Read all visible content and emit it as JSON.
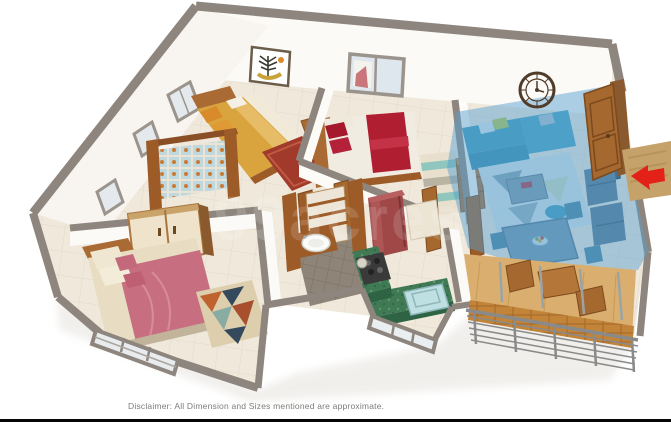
{
  "page": {
    "background_color": "#ffffff",
    "bottom_bar_color": "#050505"
  },
  "watermark": {
    "text": "99acres",
    "color": "#ffffff",
    "opacity": "0.14"
  },
  "disclaimer": {
    "text": "Disclaimer: All Dimension and Sizes mentioned are approximate."
  },
  "floorplan": {
    "type": "3d-isometric-apartment-floorplan",
    "highlight_color": "#569FD0",
    "wall_cap_color": "#8E867E",
    "floor_color": "#EFE8DB",
    "entry": {
      "arrow_color": "#E32119",
      "doormat_color": "#C4A269"
    },
    "rooms": [
      {
        "name": "bedroom-1",
        "position": "top-left",
        "features": [
          "double-bed-yellow",
          "orange-pillows",
          "red-rug",
          "wall-art-frame",
          "patterned-tile-nook",
          "wardrobe",
          "side-table",
          "windows"
        ]
      },
      {
        "name": "bedroom-2",
        "position": "top-center",
        "features": [
          "double-bed-white-red-throw",
          "red-pillows",
          "striped-rug",
          "dresser",
          "back-window",
          "wall-clock"
        ]
      },
      {
        "name": "bedroom-3",
        "position": "bottom-left",
        "features": [
          "double-bed-pink",
          "wardrobe",
          "geometric-rug",
          "front-window-grill"
        ]
      },
      {
        "name": "bathroom",
        "position": "center",
        "features": [
          "washbasin",
          "wooden-vanity",
          "ladder-shelf",
          "dark-tile-floor"
        ]
      },
      {
        "name": "kitchen",
        "position": "center-bottom",
        "features": [
          "green-granite-counter",
          "gas-stove",
          "refrigerator-maroon",
          "sink-unit",
          "front-window"
        ]
      },
      {
        "name": "living-dining",
        "position": "right",
        "highlighted": true,
        "features": [
          "l-shaped-sofa",
          "coffee-table",
          "area-rug",
          "pouf",
          "tv-unit",
          "dining-table",
          "chairs",
          "fruit-bowl"
        ]
      },
      {
        "name": "balcony",
        "position": "bottom-right",
        "features": [
          "wooden-table",
          "wooden-chairs",
          "brick-parapet",
          "metal-railing",
          "glass-partition"
        ]
      },
      {
        "name": "entrance",
        "position": "right",
        "features": [
          "open-wooden-door",
          "doormat",
          "entry-arrow"
        ]
      }
    ]
  }
}
